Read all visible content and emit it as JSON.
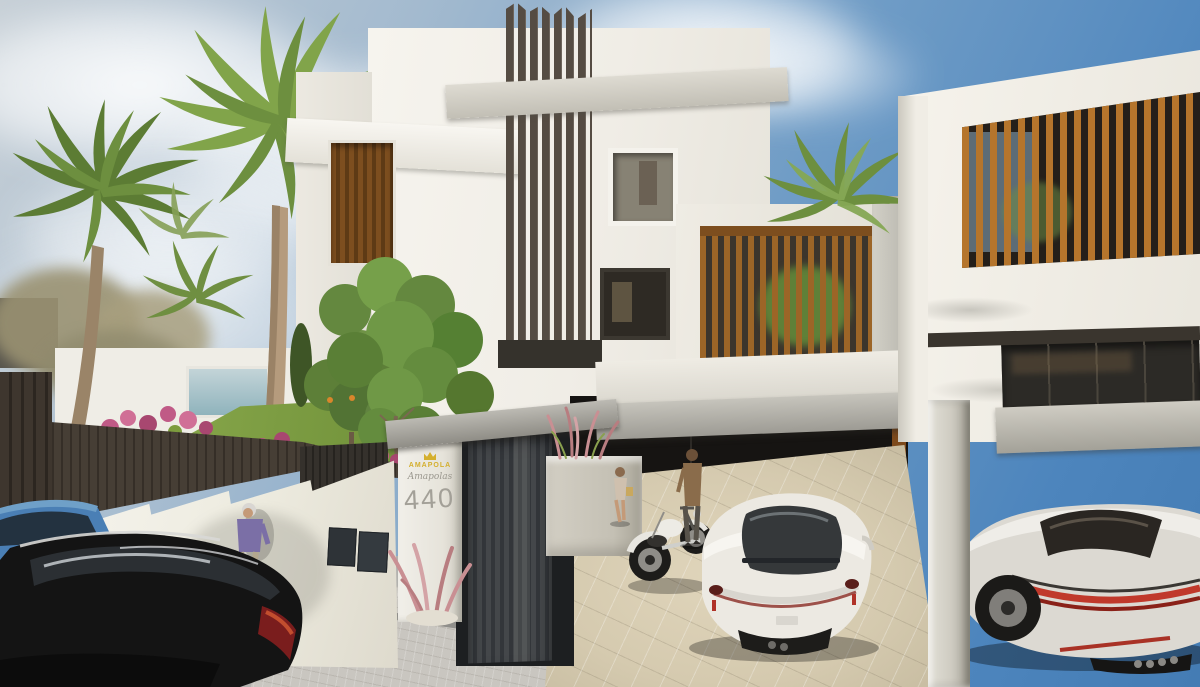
{
  "meta": {
    "type": "3d-architectural-rendering",
    "subject": "Modern white multi-unit residence with dark louver fins, wood slat screens, gated entrance and garage driveways",
    "setting": "Sunny day, blue sky with scattered clouds, palm trees, street with parked cars"
  },
  "sign": {
    "crown_icon": "crown-icon",
    "brand_text": "AMAPOLA",
    "script_text": "Amapolas",
    "street_number": "440",
    "brand_color": "#d4af2e",
    "number_color": "#a3a098"
  },
  "palette": {
    "sky_deep": "#4a82b8",
    "sky_pale": "#c2cdd6",
    "facade_white": "#f2efe9",
    "concrete": "#c6c4bb",
    "dark_fins": "#5a5148",
    "wood_louver": "#b5752c",
    "terrace_wood": "#9c6527",
    "gate_dark": "#3b3e41",
    "fence_brown": "#463e35",
    "lawn_green": "#7d9c3e",
    "flower_pink": "#c05a86",
    "driveway_beige": "#d5caaf",
    "street_gray": "#b2b1ae",
    "car_blue": "#4a7fb5",
    "car_black": "#141414",
    "car_white": "#ece9e2",
    "taillight_red": "#c0392b"
  },
  "objects": [
    {
      "name": "sky",
      "desc": "blue sky, deeper at top right, clouds at left and center"
    },
    {
      "name": "palm-trees",
      "desc": "several fan palms on the left and one between buildings"
    },
    {
      "name": "center-building",
      "desc": "white three-story volume with tall dark vertical fins and concrete beams"
    },
    {
      "name": "square-window",
      "desc": "small square window right of the fins"
    },
    {
      "name": "wood-louver-window",
      "desc": "brown louvered window on the left wing"
    },
    {
      "name": "terrace-wood-screen",
      "desc": "terrace with vertical wood slat screen and greenery behind"
    },
    {
      "name": "right-building",
      "desc": "white volume with large wood slat facade opening and tinted glass band"
    },
    {
      "name": "entrance-gate",
      "desc": "dark vertical-slat pedestrian gate under a gray concrete beam"
    },
    {
      "name": "address-sign",
      "desc": "white pillar with yellow brand logo, script name and number 440"
    },
    {
      "name": "concrete-planter",
      "desc": "concrete planter with pink ornamental grasses"
    },
    {
      "name": "garden",
      "desc": "lawn, pink bougainvillea, orange tree, water feature behind stepped white wall with brown metal fence"
    },
    {
      "name": "white-sports-car",
      "desc": "white coupe parked in center driveway"
    },
    {
      "name": "white-muscle-car",
      "desc": "white coupe with red tail stripe in right garage"
    },
    {
      "name": "vintage-motorcycle",
      "desc": "white classic motorcycle on driveway"
    },
    {
      "name": "blue-wagon-car",
      "desc": "blue estate car parked on street, partially visible"
    },
    {
      "name": "black-wagon-car",
      "desc": "black estate car parked on street in foreground"
    },
    {
      "name": "elderly-person-purple",
      "desc": "person in purple jacket walking along the wall"
    },
    {
      "name": "man-brown-jacket",
      "desc": "man standing by the motorcycle"
    },
    {
      "name": "woman-with-bag",
      "desc": "woman walking in the driveway"
    },
    {
      "name": "street-sidewalk",
      "desc": "gray street and cobbled sidewalk in foreground"
    }
  ]
}
